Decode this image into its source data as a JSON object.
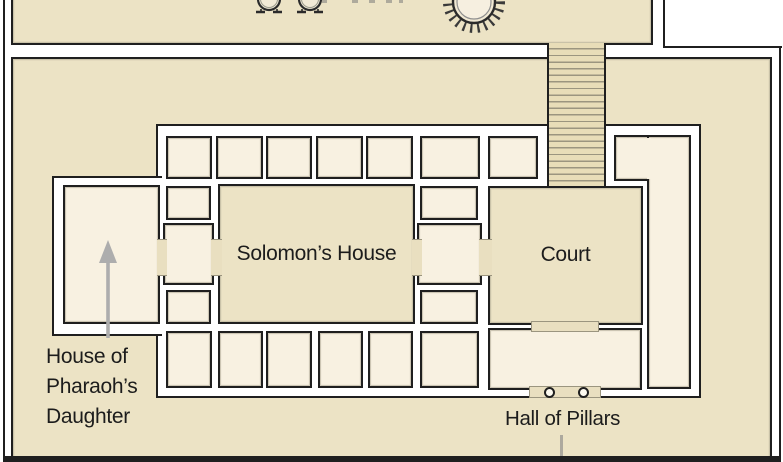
{
  "diagram": {
    "labels": {
      "solomons_house": "Solomon’s House",
      "court": "Court",
      "house_of_pharaohs_daughter": {
        "line1": "House of",
        "line2": "Pharaoh’s",
        "line3": "Daughter"
      },
      "hall_of_pillars": "Hall of Pillars"
    },
    "colors": {
      "courtyard_tan": "#ece3c5",
      "room_cream": "#f8f1e1",
      "threshold_tan": "#e9dfc0",
      "wall_black": "#1f1f1f",
      "hatch_gray": "#9b957f",
      "annotation_gray": "#adadad",
      "background_white": "#ffffff"
    },
    "icons": [
      "laver-icon",
      "bronze-sea-icon",
      "up-arrow-icon",
      "pillar-icon",
      "staircase-hatch"
    ]
  }
}
